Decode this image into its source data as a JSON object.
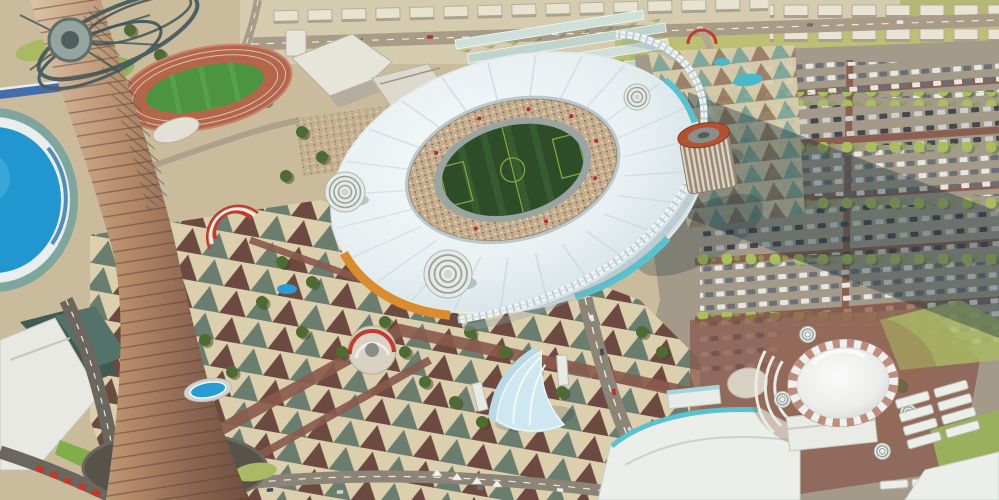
{
  "meta": {
    "description": "Aerial 3D architectural rendering of a sports city: a tall tapering spire tower in the foreground left, a large oval stadium with a white fabric roof and green football pitch in the center, a blue elliptical dome arena at the left edge, an athletics track at top left, patterned plazas with trees, vast car parks on the right, and a white serrated dome hall at bottom right."
  },
  "scene": {
    "landmarks": [
      {
        "id": "spire-tower",
        "label": "tapering spire tower with lattice crown"
      },
      {
        "id": "stadium",
        "label": "oval stadium with white membrane roof and arch"
      },
      {
        "id": "pitch",
        "label": "green football pitch with markings"
      },
      {
        "id": "blue-dome-arena",
        "label": "blue elliptical dome arena (left edge)"
      },
      {
        "id": "athletics-track",
        "label": "terracotta running track with green infield"
      },
      {
        "id": "academy-buildings",
        "label": "white low-rise academy buildings"
      },
      {
        "id": "training-halls",
        "label": "rows of pale training halls"
      },
      {
        "id": "plaza",
        "label": "triangle-patterned pedestrian plaza with palm trees"
      },
      {
        "id": "parking-lot",
        "label": "large car parks with tree rows and cast shadow"
      },
      {
        "id": "white-dome-hall",
        "label": "white dome hall with sawtooth collar and turrets"
      },
      {
        "id": "sail-canopy",
        "label": "pale blue sail shade canopy"
      },
      {
        "id": "hotel-tower",
        "label": "round striped tower with orange crown"
      },
      {
        "id": "observation-wheel",
        "label": "white ring sculpture on oval plaza"
      },
      {
        "id": "pools",
        "label": "small blue pools and ponds"
      },
      {
        "id": "highway",
        "label": "roads with cars and distant housing rows"
      }
    ],
    "palette": {
      "ground_tan": "#c9bb9b",
      "plaza_cream": "#dbcfae",
      "tri_maroon": "#6d4a41",
      "tri_slate": "#5f7568",
      "walkway_brick": "#8a5a4c",
      "roof_white": "#eef2f3",
      "pitch_green": "#2d4d29",
      "crowd_tan": "#c6ae90",
      "track_grey": "#9aa5a2",
      "orange_band": "#da8c2f",
      "teal_glass": "#58c2cf",
      "tower_light": "#dcc2a6",
      "tower_dark": "#6e4f3f",
      "dome_blue": "#2196cf",
      "pool_blue": "#2a9cd4",
      "lawn_green": "#a9b964",
      "field_yellow_green": "#bcbf74",
      "track_terracotta": "#b4664b",
      "track_field": "#4c9440",
      "parking_asphalt": "#a39a8a",
      "shadow_dark": "#243a41",
      "white_structure": "#eceee9",
      "collar_pink": "#bd8d80",
      "canopy_blue": "#cfe7f0",
      "red_accent": "#c0392b",
      "road_grey": "#a89c88",
      "lane_maroon": "#8a5a4a"
    }
  }
}
